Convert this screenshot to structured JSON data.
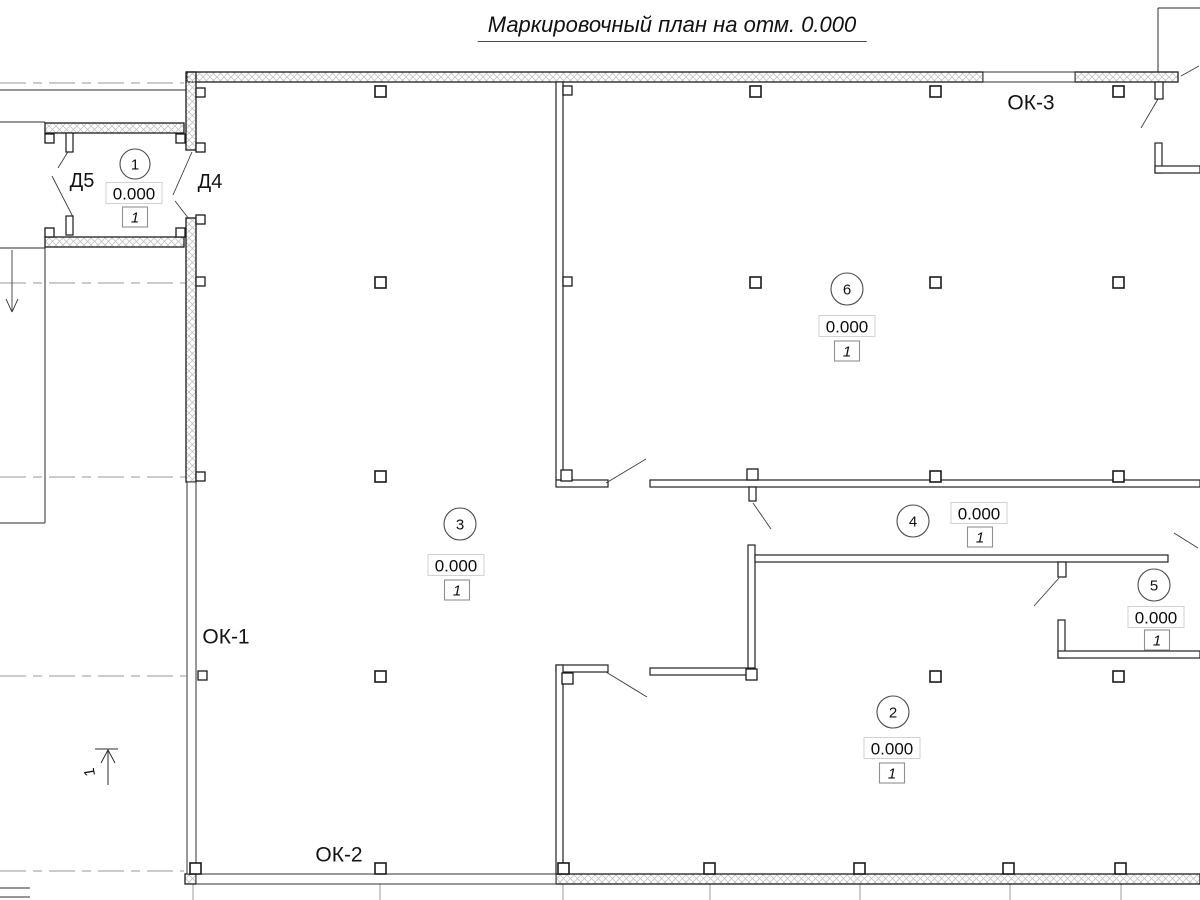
{
  "title": "Маркировочный план на отм. 0.000",
  "colors": {
    "line": "#2e2e2e",
    "hatch": "#c3c3c3",
    "dashed_axis": "#aeaeae",
    "elev_box_border": "#d2d2d2",
    "mark_box_border": "#8f8f8f",
    "background": "#ffffff"
  },
  "labels": {
    "windows": [
      {
        "name": "window-label-ok3",
        "text": "ОК-3",
        "x": 1031,
        "y": 103
      },
      {
        "name": "window-label-ok1",
        "text": "ОК-1",
        "x": 226,
        "y": 637
      },
      {
        "name": "window-label-ok2",
        "text": "ОК-2",
        "x": 339,
        "y": 855
      }
    ],
    "doors": [
      {
        "name": "door-label-d5",
        "text": "Д5",
        "x": 82,
        "y": 181
      },
      {
        "name": "door-label-d4",
        "text": "Д4",
        "x": 210,
        "y": 182
      }
    ],
    "section_mark": "1"
  },
  "rooms": [
    {
      "number": "1",
      "elevation": "0.000",
      "mark": "1",
      "circle": [
        135,
        164,
        15
      ],
      "elev_c": [
        134,
        193
      ],
      "mark_c": [
        135,
        217
      ]
    },
    {
      "number": "6",
      "elevation": "0.000",
      "mark": "1",
      "circle": [
        847,
        289,
        16
      ],
      "elev_c": [
        847,
        326
      ],
      "mark_c": [
        847,
        351
      ]
    },
    {
      "number": "3",
      "elevation": "0.000",
      "mark": "1",
      "circle": [
        460,
        524,
        16
      ],
      "elev_c": [
        456,
        565
      ],
      "mark_c": [
        457,
        590
      ]
    },
    {
      "number": "4",
      "elevation": "0.000",
      "mark": "1",
      "circle": [
        913,
        521,
        16
      ],
      "elev_c": [
        979,
        513
      ],
      "mark_c": [
        980,
        537
      ]
    },
    {
      "number": "5",
      "elevation": "0.000",
      "mark": "1",
      "circle": [
        1154,
        585,
        16
      ],
      "elev_c": [
        1156,
        617
      ],
      "mark_c": [
        1157,
        640
      ]
    },
    {
      "number": "2",
      "elevation": "0.000",
      "mark": "1",
      "circle": [
        893,
        712,
        16
      ],
      "elev_c": [
        892,
        748
      ],
      "mark_c": [
        892,
        773
      ]
    }
  ],
  "plan": {
    "hatched_walls": [
      [
        187,
        72,
        796,
        10
      ],
      [
        1075,
        72,
        103,
        10
      ],
      [
        186,
        72,
        10,
        78
      ],
      [
        186,
        218,
        10,
        264
      ],
      [
        45,
        123,
        139,
        10
      ],
      [
        45,
        237,
        139,
        10
      ],
      [
        556,
        874,
        644,
        10
      ],
      [
        185,
        874,
        11,
        10
      ]
    ],
    "thin_walls": [
      [
        556,
        82,
        7,
        398
      ],
      [
        556,
        480,
        52,
        7
      ],
      [
        650,
        480,
        550,
        7
      ],
      [
        748,
        545,
        7,
        130
      ],
      [
        755,
        555,
        413,
        7
      ],
      [
        650,
        668,
        105,
        7
      ],
      [
        556,
        665,
        52,
        7
      ],
      [
        556,
        665,
        7,
        209
      ],
      [
        1058,
        620,
        7,
        38
      ],
      [
        1058,
        651,
        142,
        7
      ],
      [
        1155,
        143,
        7,
        30
      ],
      [
        1155,
        166,
        45,
        7
      ]
    ],
    "windows": [
      [
        983,
        72,
        92,
        10
      ],
      [
        187,
        482,
        9,
        392
      ],
      [
        196,
        874,
        360,
        10
      ]
    ],
    "solid_lines": [
      [
        0,
        90,
        186,
        90
      ],
      [
        0,
        122,
        45,
        122
      ],
      [
        0,
        248,
        45,
        248
      ],
      [
        45,
        247,
        45,
        523
      ],
      [
        0,
        523,
        45,
        523
      ],
      [
        1158,
        8,
        1158,
        72
      ],
      [
        1158,
        8,
        1200,
        8
      ],
      [
        0,
        888,
        30,
        888
      ],
      [
        0,
        897,
        30,
        897
      ]
    ],
    "grid_ticks": [
      [
        193,
        884,
        193,
        900
      ],
      [
        380,
        884,
        380,
        900
      ],
      [
        563,
        884,
        563,
        900
      ],
      [
        710,
        884,
        710,
        900
      ],
      [
        860,
        884,
        860,
        900
      ],
      [
        1010,
        884,
        1010,
        900
      ],
      [
        1121,
        884,
        1121,
        900
      ]
    ],
    "dashed_lines": [
      [
        0,
        83,
        184,
        83
      ],
      [
        0,
        283,
        186,
        283
      ],
      [
        0,
        477,
        186,
        477
      ],
      [
        0,
        676,
        186,
        676
      ],
      [
        0,
        871,
        184,
        871
      ]
    ],
    "leaders": [
      [
        606,
        483,
        646,
        459
      ],
      [
        606,
        672,
        647,
        697
      ],
      [
        52,
        176,
        73,
        217
      ],
      [
        58,
        168,
        69,
        150
      ],
      [
        192,
        152,
        173,
        195
      ],
      [
        189,
        219,
        175,
        201
      ],
      [
        753,
        503,
        771,
        529
      ],
      [
        1059,
        578,
        1034,
        606
      ],
      [
        1158,
        99,
        1141,
        128
      ],
      [
        1181,
        76,
        1199,
        66
      ],
      [
        1174,
        533,
        1198,
        548
      ]
    ],
    "columns": [
      [
        375,
        86
      ],
      [
        750,
        86
      ],
      [
        930,
        86
      ],
      [
        1113,
        86
      ],
      [
        375,
        277
      ],
      [
        750,
        277
      ],
      [
        930,
        277
      ],
      [
        1113,
        277
      ],
      [
        375,
        471
      ],
      [
        930,
        471
      ],
      [
        1113,
        471
      ],
      [
        375,
        671
      ],
      [
        930,
        671
      ],
      [
        1113,
        671
      ],
      [
        190,
        863
      ],
      [
        375,
        863
      ],
      [
        558,
        863
      ],
      [
        704,
        863
      ],
      [
        854,
        863
      ],
      [
        1003,
        863
      ],
      [
        1115,
        863
      ]
    ],
    "wall_tabs": [
      [
        196,
        88
      ],
      [
        196,
        143
      ],
      [
        196,
        215
      ],
      [
        196,
        277
      ],
      [
        196,
        472
      ],
      [
        198,
        671
      ],
      [
        563,
        86
      ],
      [
        563,
        277
      ],
      [
        45,
        134
      ],
      [
        176,
        134
      ],
      [
        45,
        228
      ],
      [
        176,
        228
      ]
    ],
    "corner_tabs": [
      [
        561,
        470
      ],
      [
        747,
        469
      ],
      [
        562,
        673
      ],
      [
        746,
        669
      ]
    ],
    "jambs": [
      [
        66,
        133,
        7,
        19
      ],
      [
        66,
        216,
        7,
        19
      ],
      [
        1155,
        82,
        8,
        17
      ],
      [
        1058,
        562,
        8,
        15
      ],
      [
        749,
        487,
        7,
        14
      ]
    ],
    "down_arrow": {
      "x": 12,
      "y1": 250,
      "y2": 312
    },
    "section_mark": {
      "bar": [
        95,
        749,
        118,
        749
      ],
      "line": [
        108,
        749,
        108,
        785
      ],
      "head": [
        [
          101,
          763
        ],
        [
          108,
          750
        ],
        [
          115,
          763
        ]
      ],
      "label_x": 90,
      "label_y": 772,
      "label_rot": -100
    }
  }
}
